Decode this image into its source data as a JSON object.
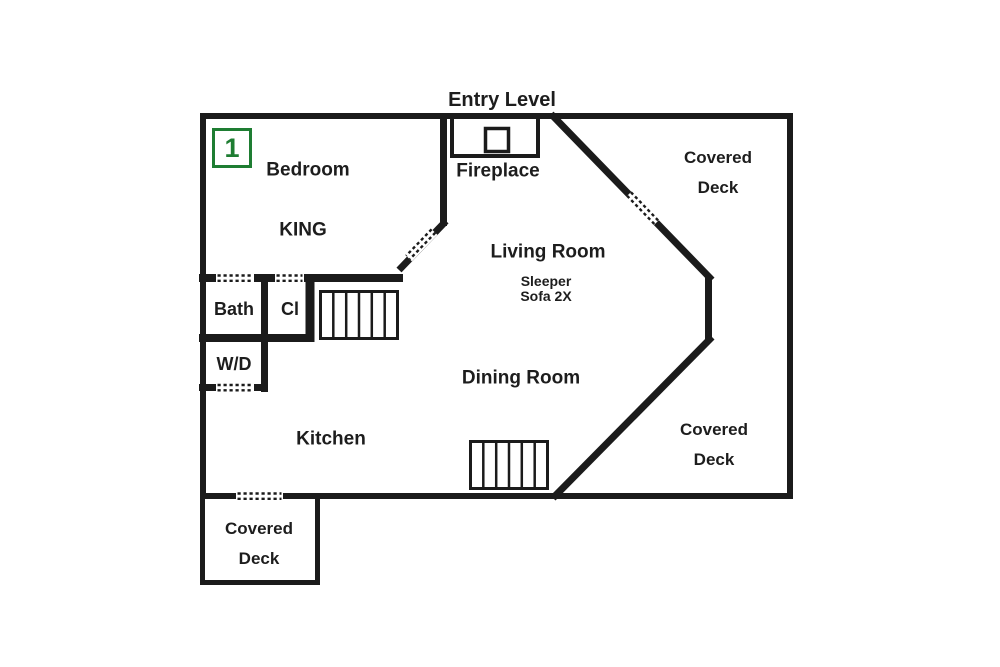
{
  "title": "Entry Level",
  "badge": {
    "number": "1",
    "color": "#1e7d32"
  },
  "rooms": {
    "bedroom": {
      "label": "Bedroom",
      "bed": "KING"
    },
    "living_room": {
      "label": "Living Room",
      "note_line1": "Sleeper",
      "note_line2": "Sofa 2X"
    },
    "dining_room": {
      "label": "Dining Room"
    },
    "kitchen": {
      "label": "Kitchen"
    },
    "bath": {
      "label": "Bath"
    },
    "closet": {
      "label": "Cl"
    },
    "washer_dryer": {
      "label": "W/D"
    },
    "fireplace": {
      "label": "Fireplace"
    }
  },
  "decks": {
    "top_right": {
      "line1": "Covered",
      "line2": "Deck"
    },
    "bottom_right": {
      "line1": "Covered",
      "line2": "Deck"
    },
    "bottom_left": {
      "line1": "Covered",
      "line2": "Deck"
    }
  },
  "stairs": {
    "upper_steps": 6,
    "lower_steps": 6
  },
  "colors": {
    "wall": "#1b1b1b",
    "background": "#ffffff",
    "badge_green": "#1e7d32",
    "text": "#1d1d1d"
  }
}
